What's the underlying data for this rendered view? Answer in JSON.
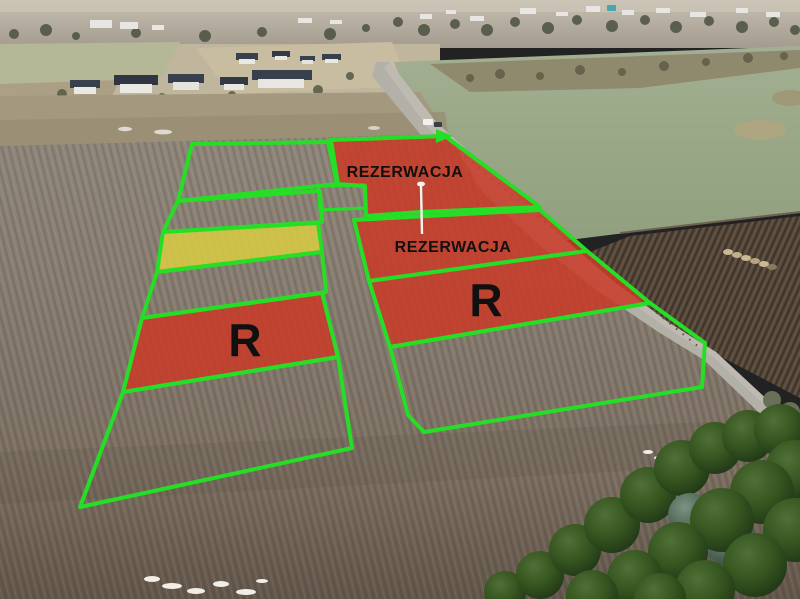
{
  "labels": {
    "reservation_top": "REZERWACJA",
    "reservation_mid": "REZERWACJA",
    "r_left": "R",
    "r_right": "R"
  },
  "plots": [
    {
      "id": "left-1",
      "fill": "none",
      "label": ""
    },
    {
      "id": "left-2",
      "fill": "none",
      "label": ""
    },
    {
      "id": "left-yellow",
      "fill": "yellow",
      "label": ""
    },
    {
      "id": "left-3",
      "fill": "none",
      "label": ""
    },
    {
      "id": "left-red",
      "fill": "red",
      "label": "R"
    },
    {
      "id": "left-4",
      "fill": "none",
      "label": ""
    },
    {
      "id": "right-top",
      "fill": "red",
      "label": "REZERWACJA"
    },
    {
      "id": "right-small",
      "fill": "none",
      "label": ""
    },
    {
      "id": "right-mid",
      "fill": "red",
      "label": "REZERWACJA"
    },
    {
      "id": "right-r",
      "fill": "red",
      "label": "R"
    },
    {
      "id": "right-bottom",
      "fill": "none",
      "label": ""
    }
  ],
  "colors": {
    "plot-green": "#26de26",
    "reserved-red": "#c93a28",
    "available-yellow": "#d7ca43",
    "label-black": "#101010",
    "field-light": "#8e857a",
    "field-mid": "#84796d",
    "field-dark": "#6b5e52",
    "meadow-green": "#9aa888",
    "dark-field": "#54463a",
    "road-gray": "#b3b0a7",
    "tree-dark": "#26401f",
    "tree-light": "#4a6b33",
    "haze-top": "#bdb5a7",
    "haze-bottom": "#a8a196",
    "house-roof": "#39404d",
    "house-wall": "#eae8e3"
  }
}
